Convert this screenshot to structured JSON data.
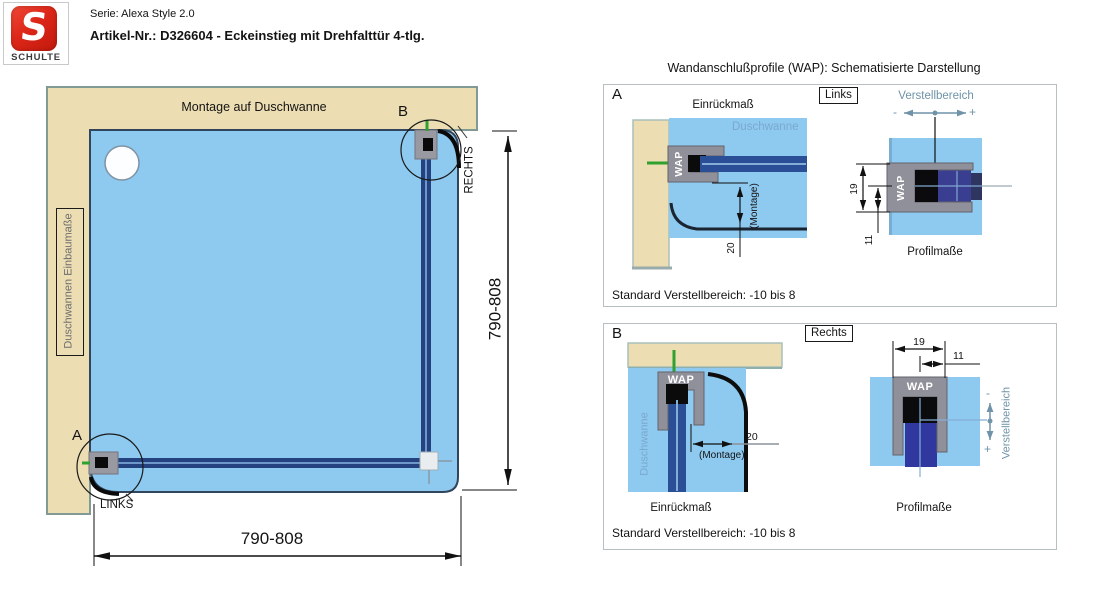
{
  "header": {
    "brand": "SCHULTE",
    "logo_letter": "S",
    "serie": "Serie: Alexa Style 2.0",
    "artikel": "Artikel-Nr.: D326604 - Eckeinstieg mit Drehfalttür 4-tlg."
  },
  "plan": {
    "wall_label": "Montage auf Duschwanne",
    "tray_box_label": "Duschwannen Einbaumaße",
    "detail_a": "A",
    "detail_b": "B",
    "links": "LINKS",
    "rechts": "RECHTS",
    "width_dim": "790-808",
    "height_dim": "790-808"
  },
  "wap": {
    "title": "Wandanschlußprofile (WAP): Schematisierte Darstellung",
    "labels": {
      "einrueckmass": "Einrückmaß",
      "duschwanne": "Duschwanne",
      "wap": "WAP",
      "montage": "(Montage)",
      "verstellbereich": "Verstellbereich",
      "profilmasse": "Profilmaße",
      "standard": "Standard Verstellbereich: -10 bis 8",
      "minus": "-",
      "plus": "+",
      "dim20": "20",
      "dim19": "19",
      "dim11": "11"
    },
    "panel_a": {
      "letter": "A",
      "side": "Links"
    },
    "panel_b": {
      "letter": "B",
      "side": "Rechts"
    }
  },
  "colors": {
    "brand_red": "#d8271c",
    "wall_beige": "#ecddb2",
    "tray_blue": "#8ec9f0",
    "glass_blue": "#2b4f96",
    "glass_violet": "#3a3e90",
    "glass_black": "#0b0b0b",
    "profile_gray": "#90909a",
    "steel_blue": "#6f93a8",
    "anchor_green": "#2fa12f"
  }
}
